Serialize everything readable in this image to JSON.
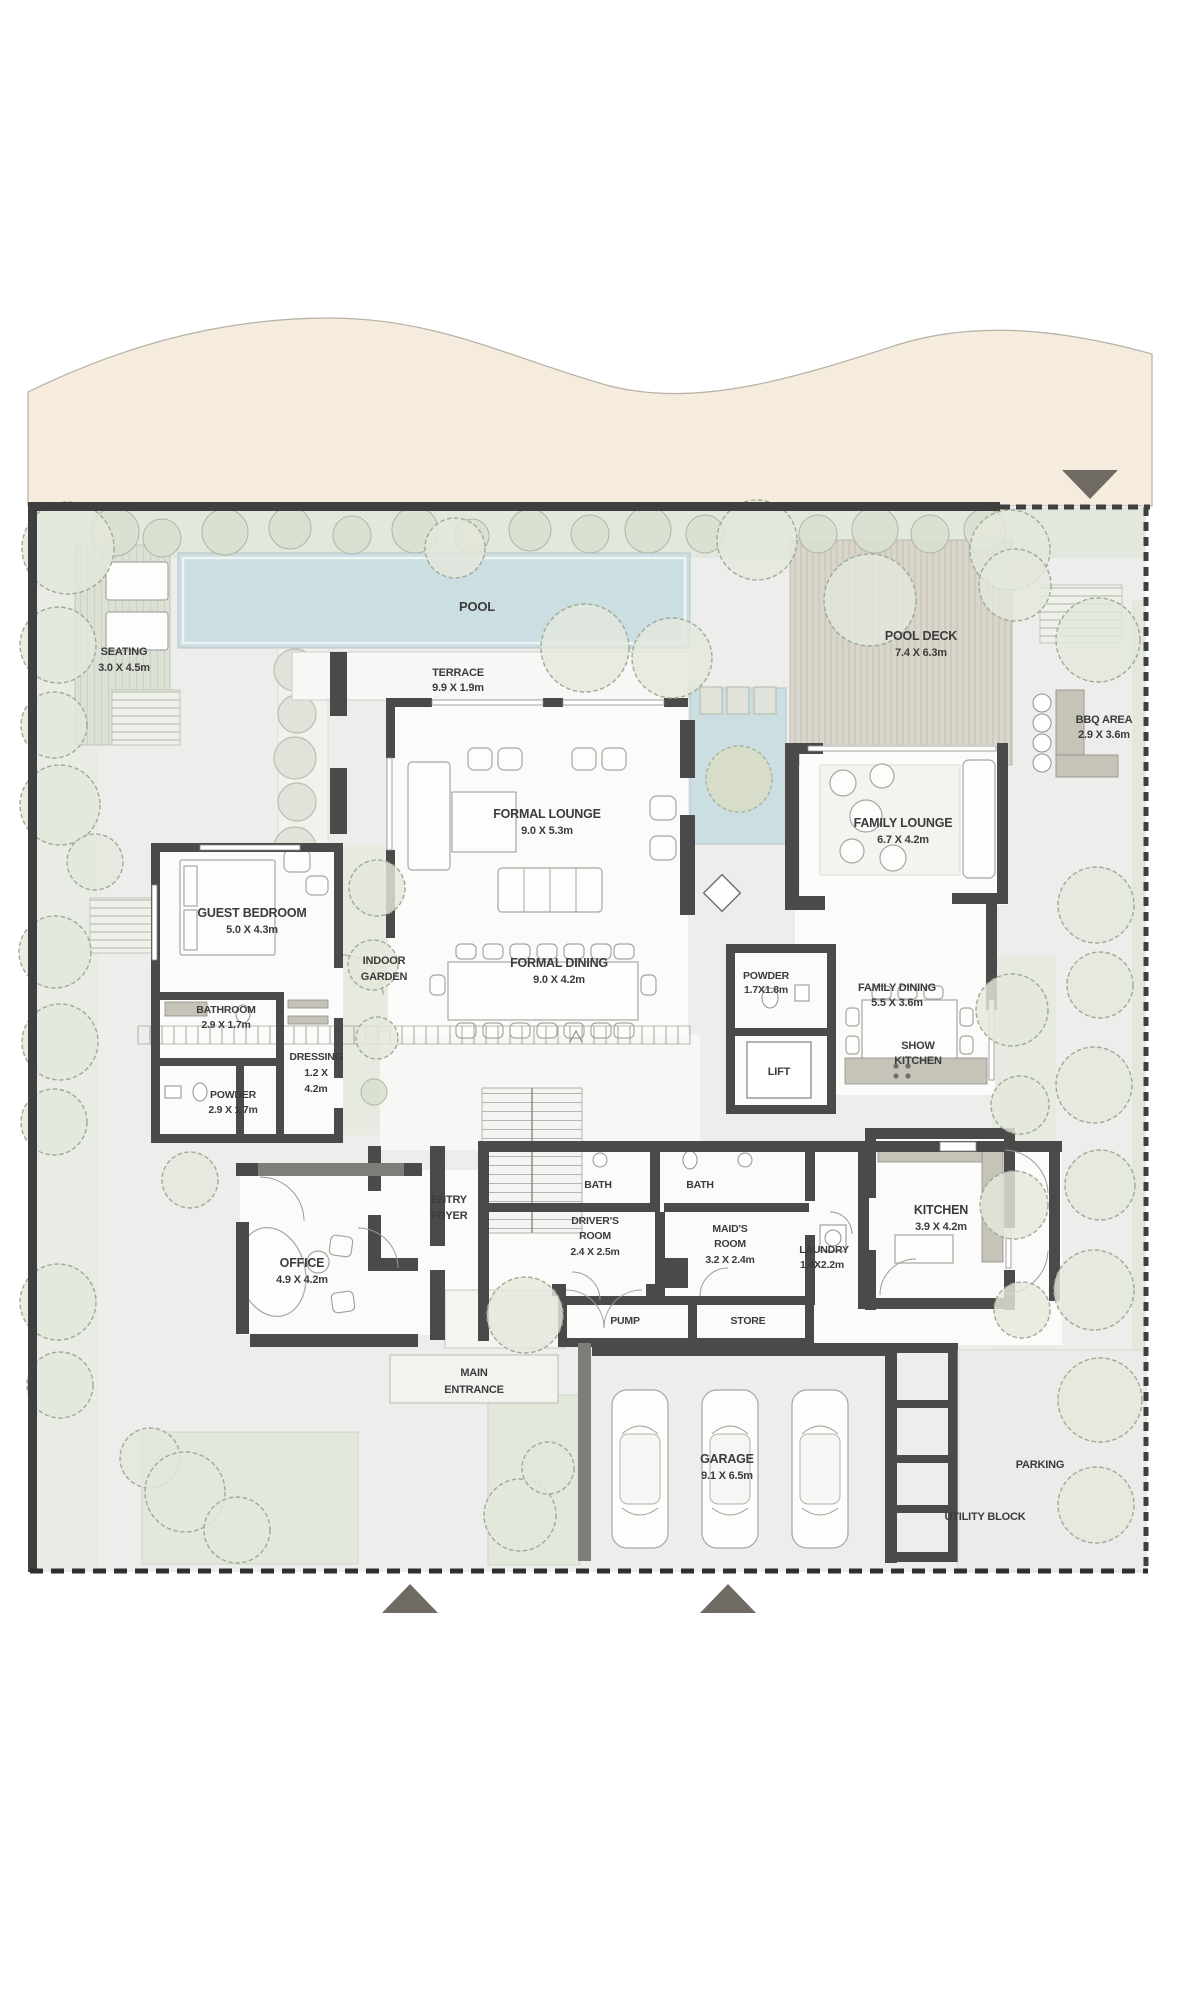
{
  "plan_type": "villa-ground-floor-plan",
  "colors": {
    "sand": "#f6ecdd",
    "ground": "#ededeb",
    "greenery": "#e6eae1",
    "hedge": "#e3e8de",
    "pool_water": "#cbdee2",
    "deck": "#d8d5ca",
    "seating_deck": "#dce1d6",
    "wall": "#4a4a4a",
    "boundary": "#3f3f3f",
    "marker": "#6f6b63",
    "room_floor": "#fbfbfa",
    "label_text": "#3c3c3c"
  },
  "rooms": {
    "seating": {
      "name": "SEATING",
      "dims": "3.0 X 4.5m"
    },
    "pool": {
      "name": "POOL"
    },
    "terrace": {
      "name": "TERRACE",
      "dims": "9.9 X 1.9m"
    },
    "pool_deck": {
      "name": "POOL DECK",
      "dims": "7.4 X 6.3m"
    },
    "bbq_area": {
      "name": "BBQ AREA",
      "dims": "2.9 X 3.6m"
    },
    "formal_lounge": {
      "name": "FORMAL LOUNGE",
      "dims": "9.0 X 5.3m"
    },
    "family_lounge": {
      "name": "FAMILY LOUNGE",
      "dims": "6.7 X 4.2m"
    },
    "guest_bedroom": {
      "name": "GUEST BEDROOM",
      "dims": "5.0 X 4.3m"
    },
    "bathroom": {
      "name": "BATHROOM",
      "dims": "2.9 X 1.7m"
    },
    "powder_guest": {
      "name": "POWDER",
      "dims": "2.9 X 1.7m"
    },
    "dressing": {
      "name": "DRESSING",
      "dims1": "1.2 X",
      "dims2": "4.2m"
    },
    "indoor_garden": {
      "line1": "INDOOR",
      "line2": "GARDEN"
    },
    "formal_dining": {
      "name": "FORMAL DINING",
      "dims": "9.0 X 4.2m"
    },
    "powder": {
      "name": "POWDER",
      "dims": "1.7X1.8m"
    },
    "lift": {
      "name": "LIFT"
    },
    "family_dining": {
      "name": "FAMILY DINING",
      "dims": "5.5 X 3.6m"
    },
    "show_kitchen": {
      "line1": "SHOW",
      "line2": "KITCHEN"
    },
    "kitchen": {
      "name": "KITCHEN",
      "dims": "3.9 X 4.2m"
    },
    "entry_foyer": {
      "line1": "ENTRY",
      "line2": "FOYER"
    },
    "office": {
      "name": "OFFICE",
      "dims": "4.9 X 4.2m"
    },
    "bath_1": {
      "name": "BATH"
    },
    "bath_2": {
      "name": "BATH"
    },
    "drivers_room": {
      "line1": "DRIVER'S",
      "line2": "ROOM",
      "dims": "2.4 X 2.5m"
    },
    "maids_room": {
      "line1": "MAID'S",
      "line2": "ROOM",
      "dims": "3.2 X 2.4m"
    },
    "laundry": {
      "name": "LAUNDRY",
      "dims": "1.4X2.2m"
    },
    "pump": {
      "name": "PUMP"
    },
    "store": {
      "name": "STORE"
    },
    "main_entrance": {
      "line1": "MAIN",
      "line2": "ENTRANCE"
    },
    "garage": {
      "name": "GARAGE",
      "dims": "9.1 X 6.5m"
    },
    "parking": {
      "name": "PARKING"
    },
    "utility_block": {
      "name": "UTILITY BLOCK"
    }
  }
}
